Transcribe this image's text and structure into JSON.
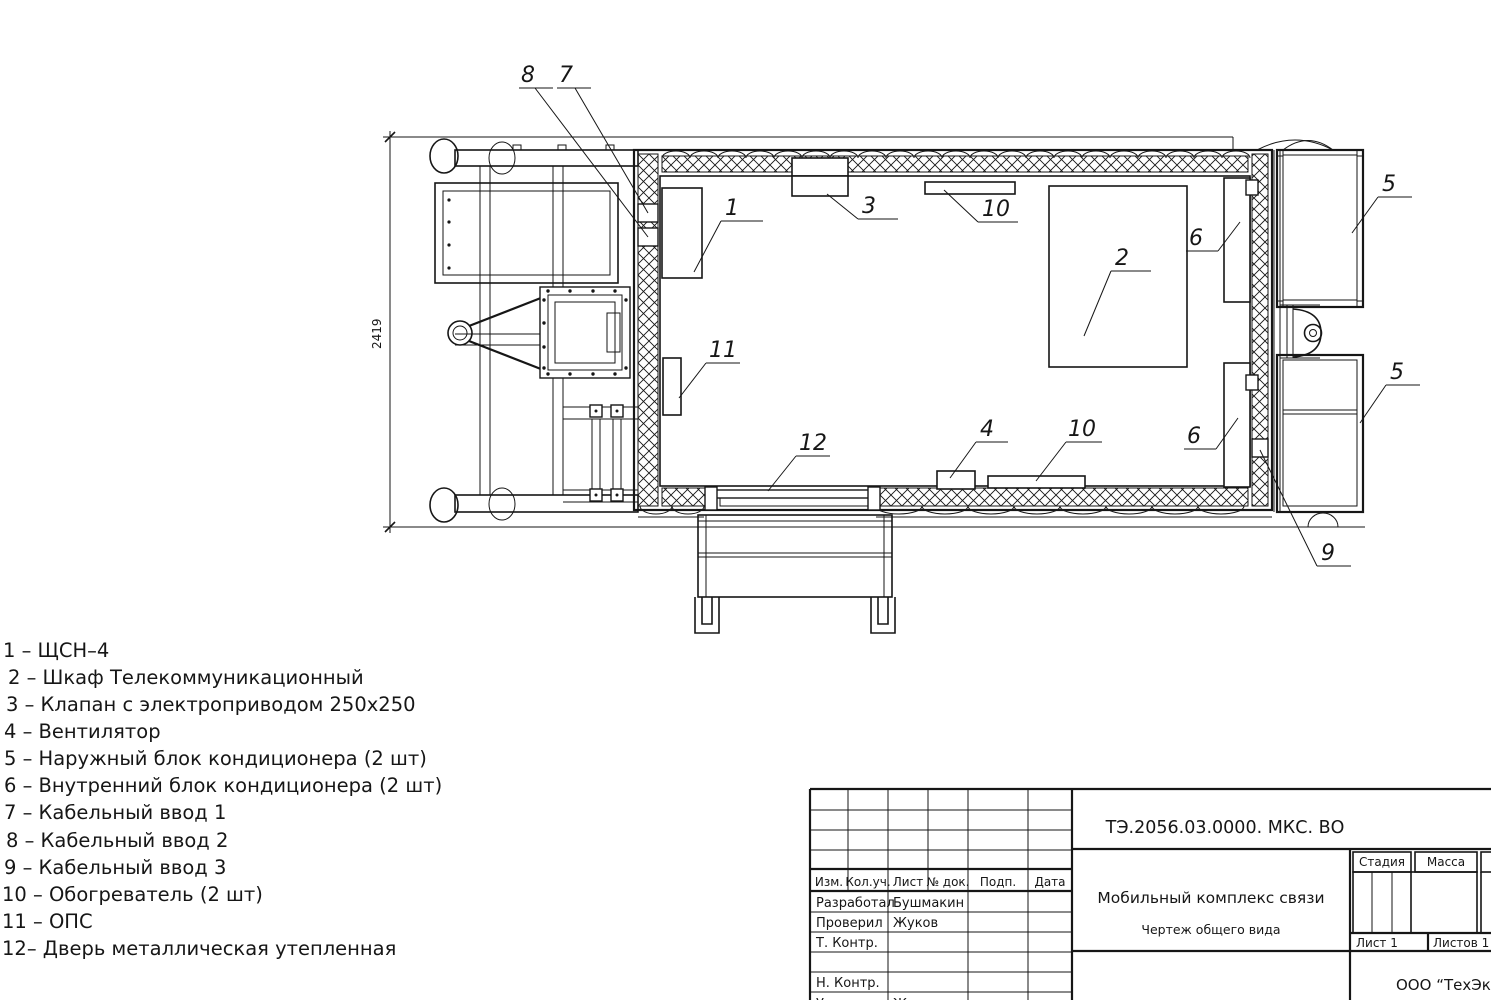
{
  "drawing": {
    "dimension": "2419",
    "callouts": {
      "c1": "1",
      "c2": "2",
      "c3": "3",
      "c4": "4",
      "c5_top": "5",
      "c5_bottom": "5",
      "c6_top": "6",
      "c6_bottom": "6",
      "c7": "7",
      "c8": "8",
      "c9": "9",
      "c10_top": "10",
      "c10_bottom": "10",
      "c11": "11",
      "c12": "12"
    }
  },
  "legend": {
    "items": [
      "1 – ЩСН–4",
      "2 – Шкаф Телекоммуникационный",
      "3 – Клапан с электроприводом 250х250",
      "4 – Вентилятор",
      "5 – Наружный блок кондиционера (2 шт)",
      "6 – Внутренний блок кондиционера (2 шт)",
      "7 –  Кабельный ввод 1",
      "8 – Кабельный ввод 2",
      "9 – Кабельный ввод 3",
      "10 – Обогреватель (2 шт)",
      "11 – ОПС",
      "12– Дверь металлическая утепленная"
    ]
  },
  "title_block": {
    "doc_number": "ТЭ.2056.03.0000. МКС. ВО",
    "product_name": "Мобильный комплекс связи",
    "doc_type": "Чертеж общего вида",
    "company": "ООО “ТехЭксп",
    "stage_label": "Стадия",
    "mass_label": "Масса",
    "sheet_label": "Лист 1",
    "sheets_label": "Листов 1",
    "columns": {
      "izm": "Изм.",
      "kol": "Кол.уч.",
      "list": "Лист",
      "doc": "№ док.",
      "podp": "Подп.",
      "data": "Дата"
    },
    "roles": [
      {
        "role": "Разработал",
        "name": "Бушмакин"
      },
      {
        "role": "Проверил",
        "name": "Жуков"
      },
      {
        "role": "Т. Контр.",
        "name": ""
      },
      {
        "role": "",
        "name": ""
      },
      {
        "role": "Н. Контр.",
        "name": ""
      },
      {
        "role": "Утв.",
        "name": "Жуков"
      }
    ]
  }
}
